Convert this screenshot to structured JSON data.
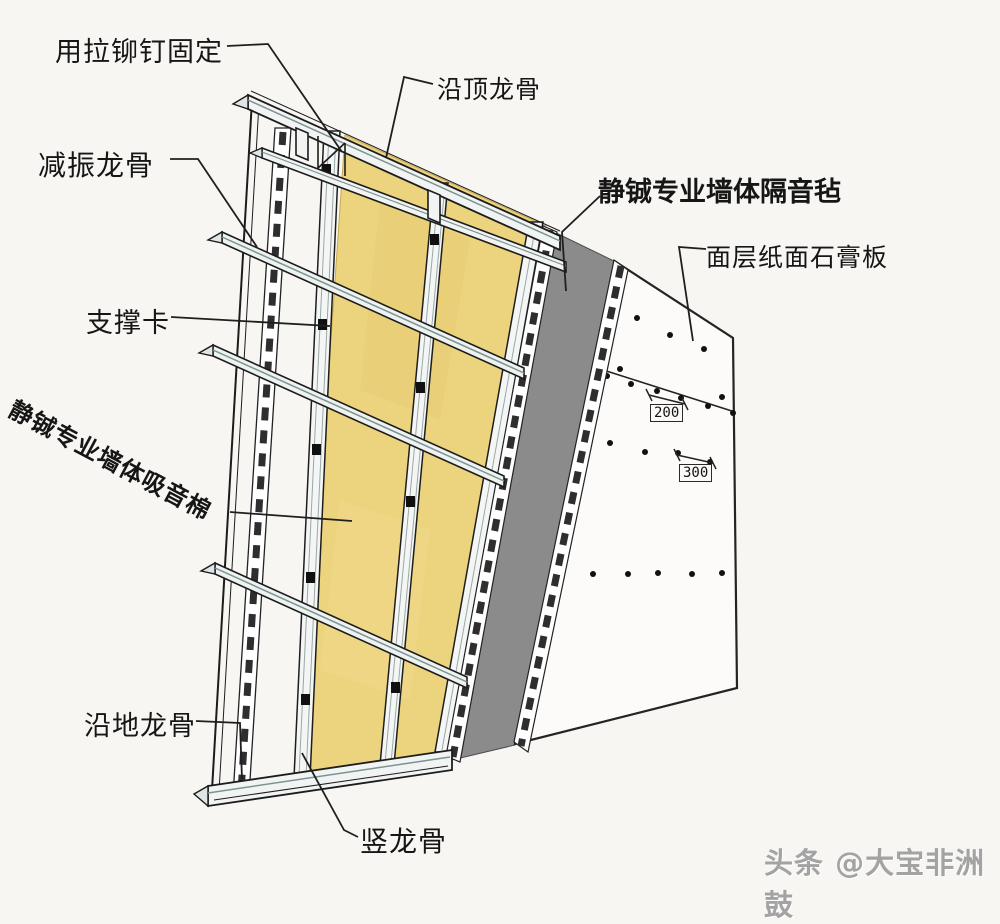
{
  "figure": {
    "title": "墙体隔音构造示意图",
    "background": "#f7f6f3",
    "colors": {
      "insulation_yellow": "#ecd37d",
      "felt_gray": "#8b8b8b",
      "board_white": "#fcfbf9",
      "steel_fill": "#f1f4f3",
      "line_dark": "#1c1c1c",
      "watermark_gray": "#a3a3a3"
    },
    "labels": {
      "rivet_fix": {
        "text": "用拉铆钉固定"
      },
      "top_track": {
        "text": "沿顶龙骨"
      },
      "damping_channel": {
        "text": "减振龙骨"
      },
      "support_clip": {
        "text": "支撑卡"
      },
      "absorb_cotton": {
        "text": "静铖专业墙体吸音棉"
      },
      "isolation_felt": {
        "text": "静铖专业墙体隔音毡"
      },
      "gypsum_board": {
        "text": "面层纸面石膏板"
      },
      "floor_track": {
        "text": "沿地龙骨"
      },
      "vertical_stud": {
        "text": "竖龙骨"
      }
    },
    "dimensions": {
      "d200": "200",
      "d300": "300"
    },
    "watermark": "头条 @大宝非洲鼓"
  }
}
